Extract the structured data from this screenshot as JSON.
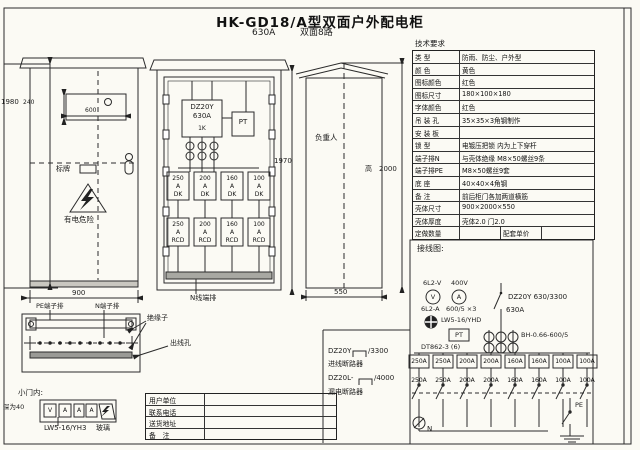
{
  "page": {
    "title": "HK-GD18/A型双面户外配电柜",
    "subtitle_current": "630A",
    "subtitle_type": "双面8路"
  },
  "front_view": {
    "dim_height": "1980",
    "dim_sign_height": "240",
    "dim_sign_width": "600",
    "dim_width": "900",
    "nameplate": "标牌",
    "warning": "有电危险",
    "pe_box": "PE端子排",
    "n_box": "N端子排",
    "insulator": "绝缘子",
    "outlet_hole": "出线孔"
  },
  "inner_view": {
    "main_model": "DZ20Y",
    "main_rating": "630A",
    "main_tag": "1K",
    "pt": "PT",
    "dim_height": "1970",
    "bus_label": "N线端排",
    "row1": [
      {
        "a": "250",
        "u": "A",
        "t": "DK"
      },
      {
        "a": "200",
        "u": "A",
        "t": "DK"
      },
      {
        "a": "160",
        "u": "A",
        "t": "DK"
      },
      {
        "a": "100",
        "u": "A",
        "t": "DK"
      }
    ],
    "row2": [
      {
        "a": "250",
        "u": "A",
        "t": "RCD"
      },
      {
        "a": "200",
        "u": "A",
        "t": "RCD"
      },
      {
        "a": "160",
        "u": "A",
        "t": "RCD"
      },
      {
        "a": "100",
        "u": "A",
        "t": "RCD"
      }
    ]
  },
  "side_view": {
    "center_label": "负重人",
    "dim_height_prefix": "高",
    "dim_height": "2000",
    "dim_depth": "550"
  },
  "door_detail": {
    "caption": "小门内:",
    "depth_note": "深为40",
    "meters": [
      "V",
      "A",
      "A",
      "A"
    ],
    "model": "LW5-16/YH3",
    "glass": "玻璃"
  },
  "tech_table": {
    "title": "技术要求",
    "rows": [
      {
        "label": "类  型",
        "value": "防雨、防尘、户外型"
      },
      {
        "label": "颜  色",
        "value": "黄色"
      },
      {
        "label": "图标颜色",
        "value": "红色"
      },
      {
        "label": "图标尺寸",
        "value": "180×100×180"
      },
      {
        "label": "字体颜色",
        "value": "红色"
      },
      {
        "label": "吊 装 孔",
        "value": "35×35×3角钢制作"
      },
      {
        "label": "安 装 板",
        "value": ""
      },
      {
        "label": "锁  型",
        "value": "电镀压把锁 内为上下穿杆"
      },
      {
        "label": "端子排N",
        "value": "与壳体绝缘 M8×50螺丝9条"
      },
      {
        "label": "端子排PE",
        "value": "M8×50螺丝9套"
      },
      {
        "label": "底  座",
        "value": "40×40×4角钢"
      },
      {
        "label": "备  注",
        "value": "前后柜门各加两道横筋"
      },
      {
        "label": "壳体尺寸",
        "value": "900×2000×550"
      },
      {
        "label": "壳体厚度",
        "value": "壳体2.0  门2.0"
      }
    ],
    "footer": {
      "c1": "定做数量",
      "c3": "配套单价"
    }
  },
  "wiring": {
    "caption": "接线图:",
    "voltmeter_model": "6L2-V",
    "voltmeter_rating": "400V",
    "voltmeter_symbol": "V",
    "ammeter_model": "6L2-A",
    "ammeter_ratio": "600/5 ×3",
    "ammeter_symbol": "A",
    "selector_model": "LW5-16/YHD",
    "pt_label": "PT",
    "energy_meter": "DT862-3 (6)",
    "main_breaker": "DZ20Y 630/3300",
    "main_current": "630A",
    "ct_model": "BH-0.66-600/5",
    "branch_ratings_top": [
      "250A",
      "250A",
      "200A",
      "200A",
      "160A",
      "160A",
      "100A",
      "100A"
    ],
    "branch_ratings_bottom": [
      "250A",
      "250A",
      "200A",
      "200A",
      "160A",
      "160A",
      "100A",
      "100A"
    ],
    "neutral_label": "N",
    "pe_label": "PE"
  },
  "legend": {
    "item1_model": "DZ20Y",
    "item1_suffix": "/3300",
    "item1_name": "进线断路器",
    "item2_model": "DZ20L-",
    "item2_suffix": "/4000",
    "item2_name": "漏电断路器"
  },
  "order_table": {
    "rows": [
      {
        "label": "用户单位"
      },
      {
        "label": "联系电话"
      },
      {
        "label": "送货地址"
      },
      {
        "label": "备　注"
      }
    ]
  }
}
